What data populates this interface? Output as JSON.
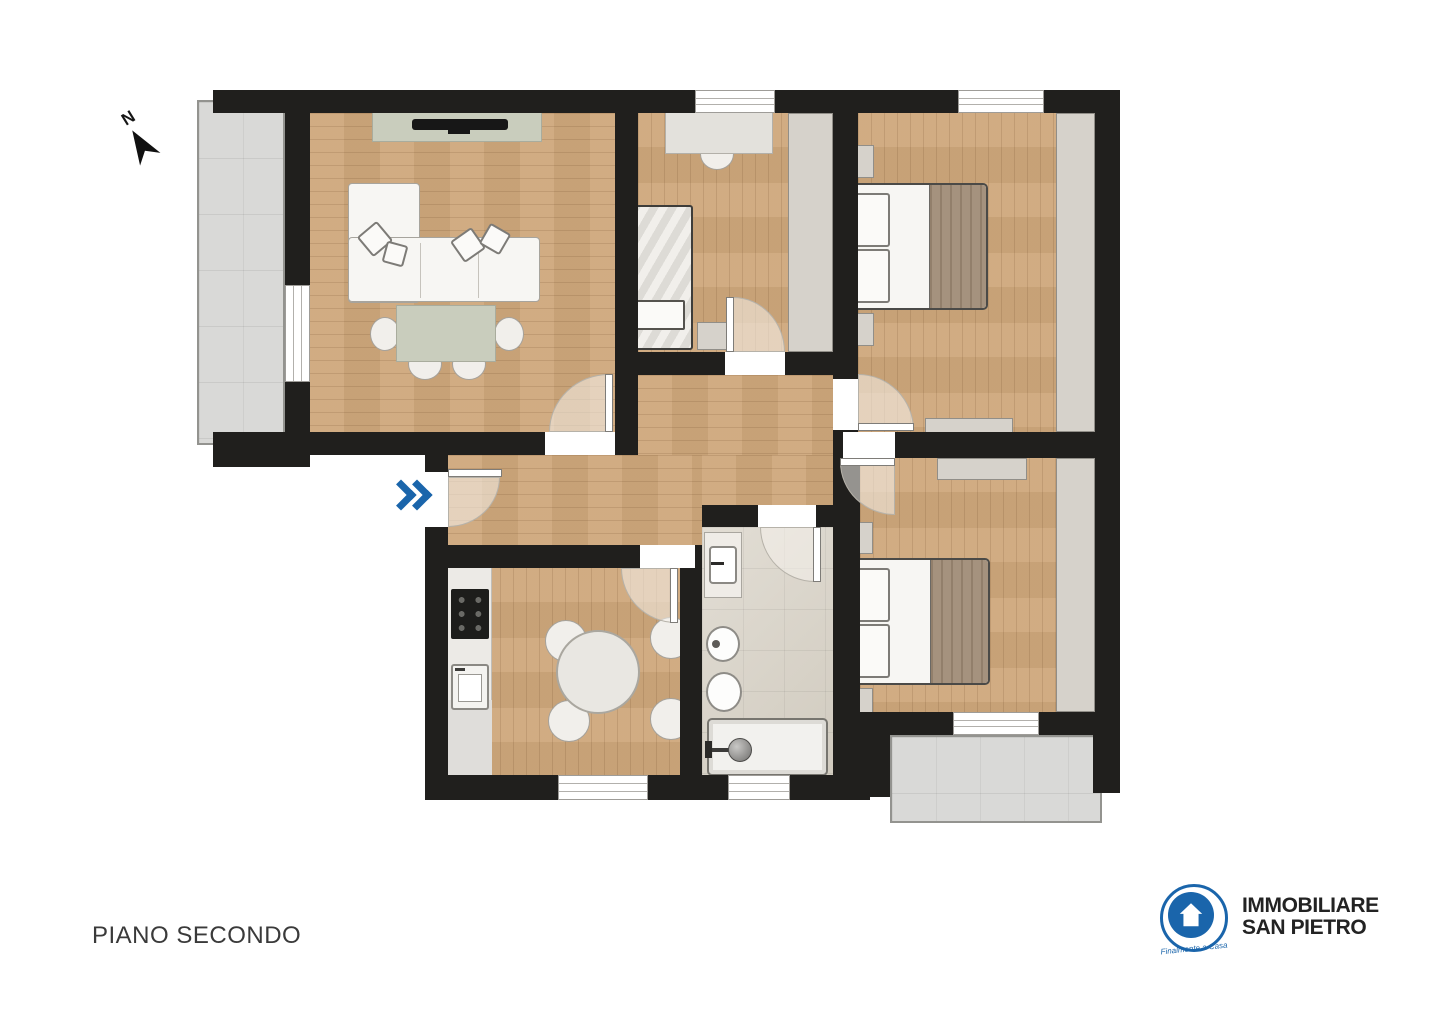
{
  "title": {
    "floor_label": "PIANO SECONDO"
  },
  "compass": {
    "label": "N"
  },
  "logo": {
    "name_line1": "IMMOBILIARE",
    "name_line2": "SAN PIETRO",
    "tagline": "Finalmente a Casa"
  },
  "colors": {
    "wall": "#201f1d",
    "wood": "#cfa87c",
    "balcony": "#d9d9d7",
    "bath": "#d8d2c6",
    "furn": "#d6d2cb",
    "counter": "#eceae6",
    "blanket": "#a5927e",
    "blue": "#1a65ab",
    "text": "#3a3a3a",
    "logo-text": "#232323"
  }
}
